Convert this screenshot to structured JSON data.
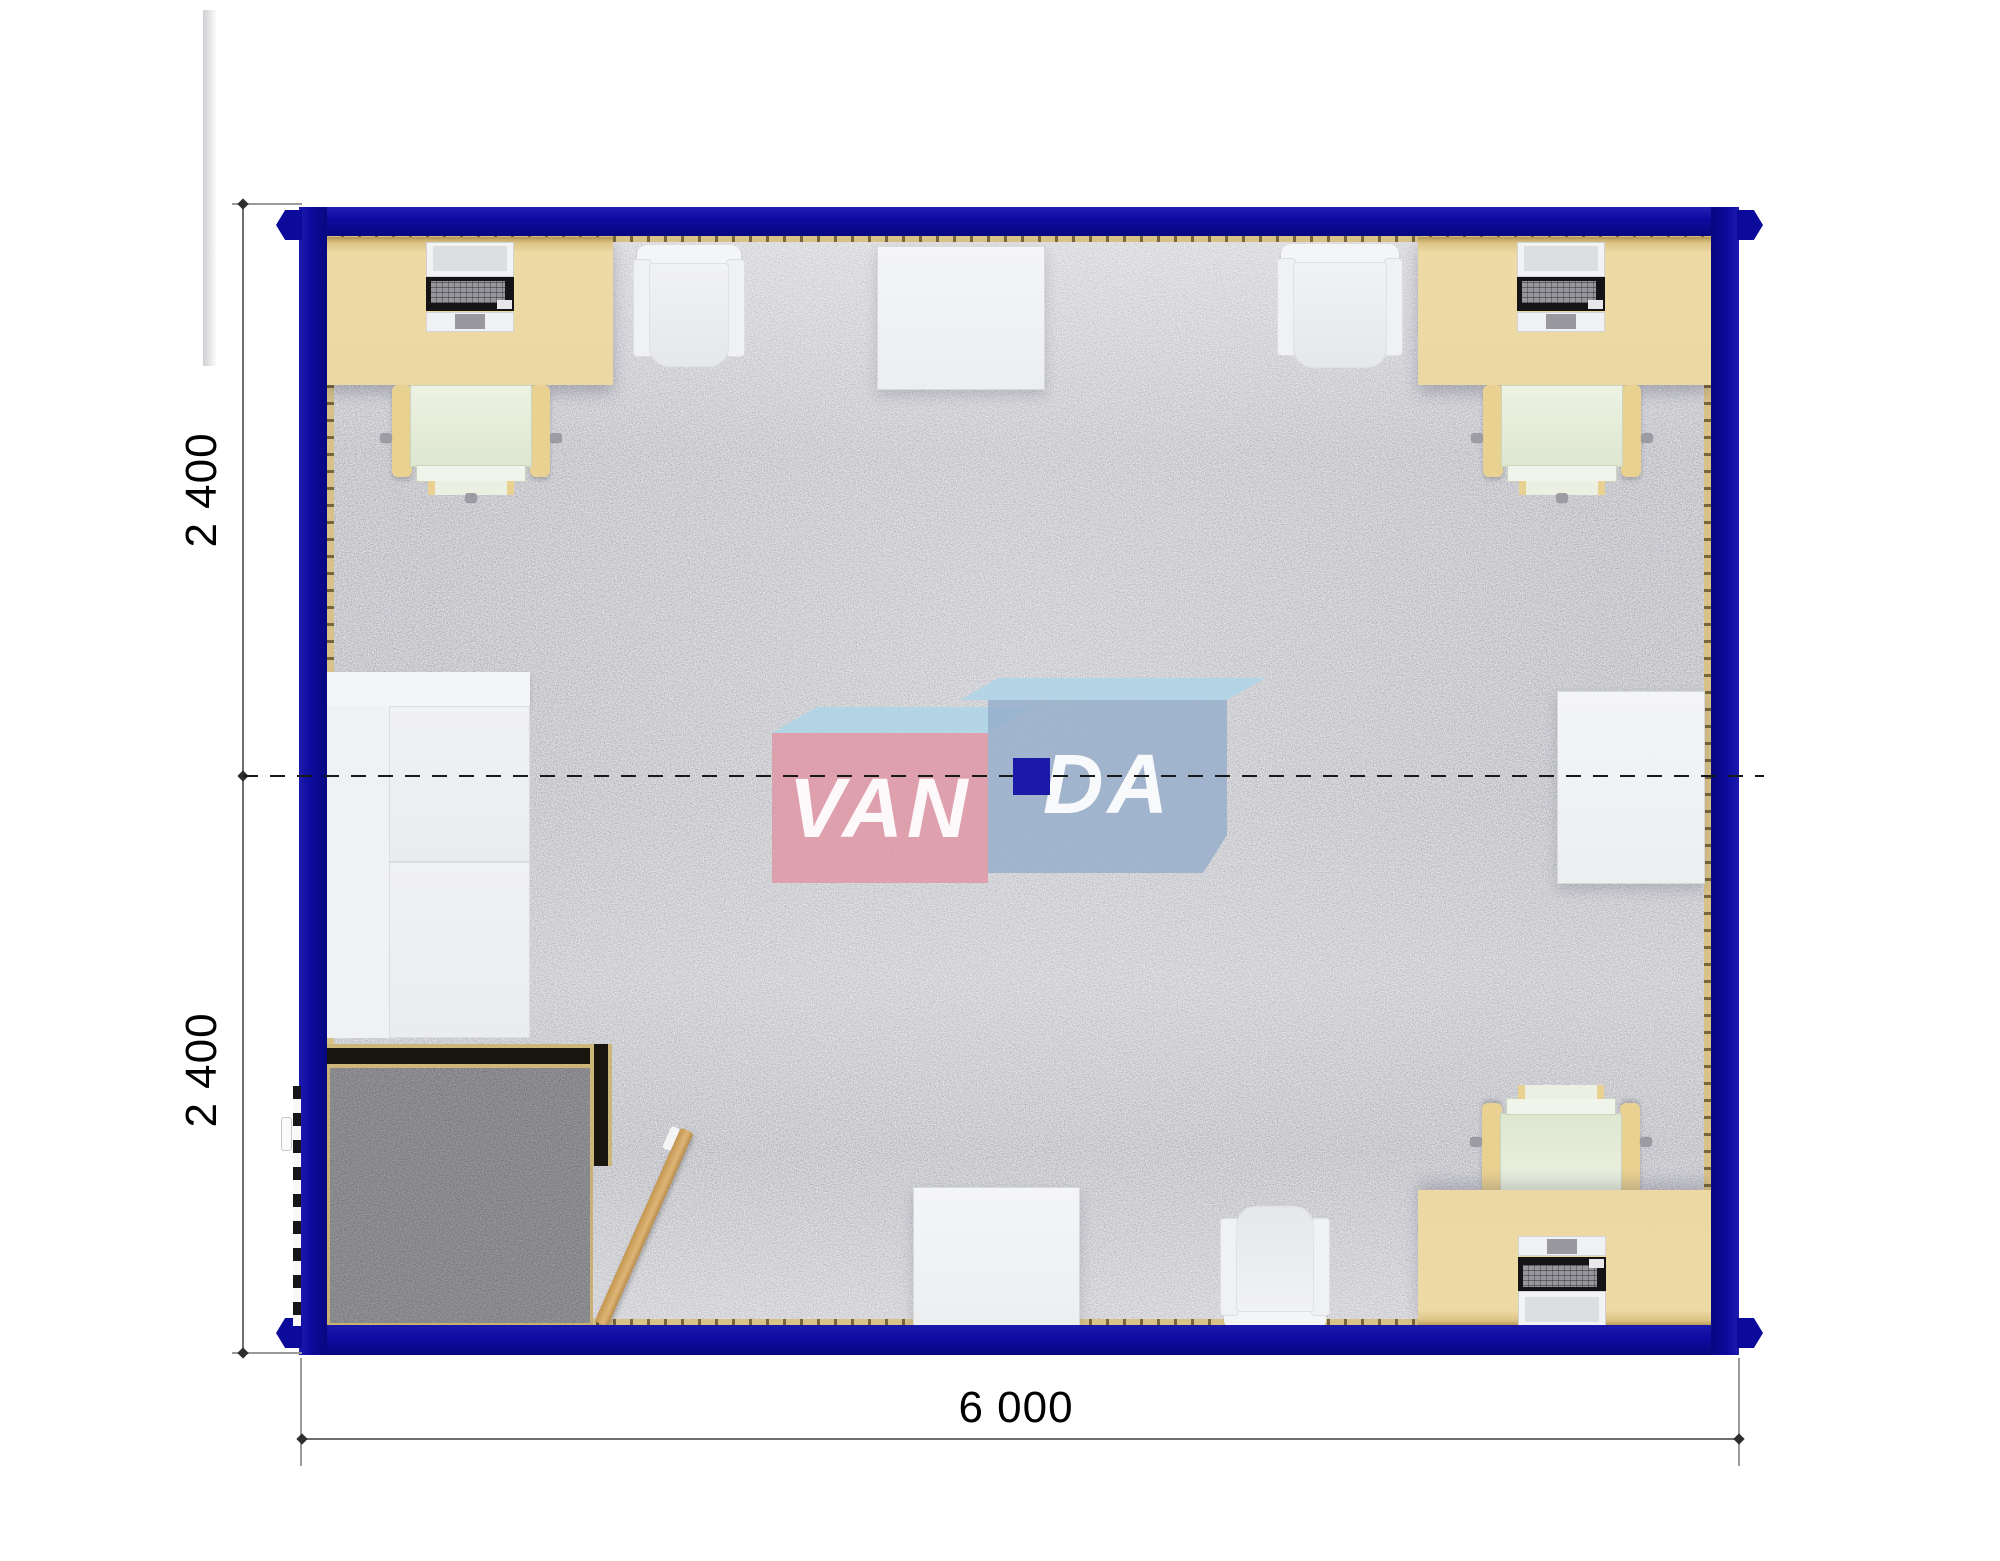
{
  "dimension_labels": {
    "side_top": "2 400",
    "side_bottom": "2 400",
    "bottom": "6 000"
  },
  "watermark": {
    "left": "VAN",
    "right": "DA"
  },
  "palette": {
    "frame_blue": "#0c0a9b",
    "desk_beige": "#ecd8a2",
    "carpet_light": "#cfd0d4",
    "carpet_entry_dark": "#9a9a9e",
    "wall_trim_tan": "#d8c287",
    "watermark_pink": "#e194a4",
    "watermark_blue": "#94acc9",
    "watermark_sky": "#aed5e8",
    "center_square_blue": "#1c18a8",
    "door_wood": "#d3a360"
  }
}
